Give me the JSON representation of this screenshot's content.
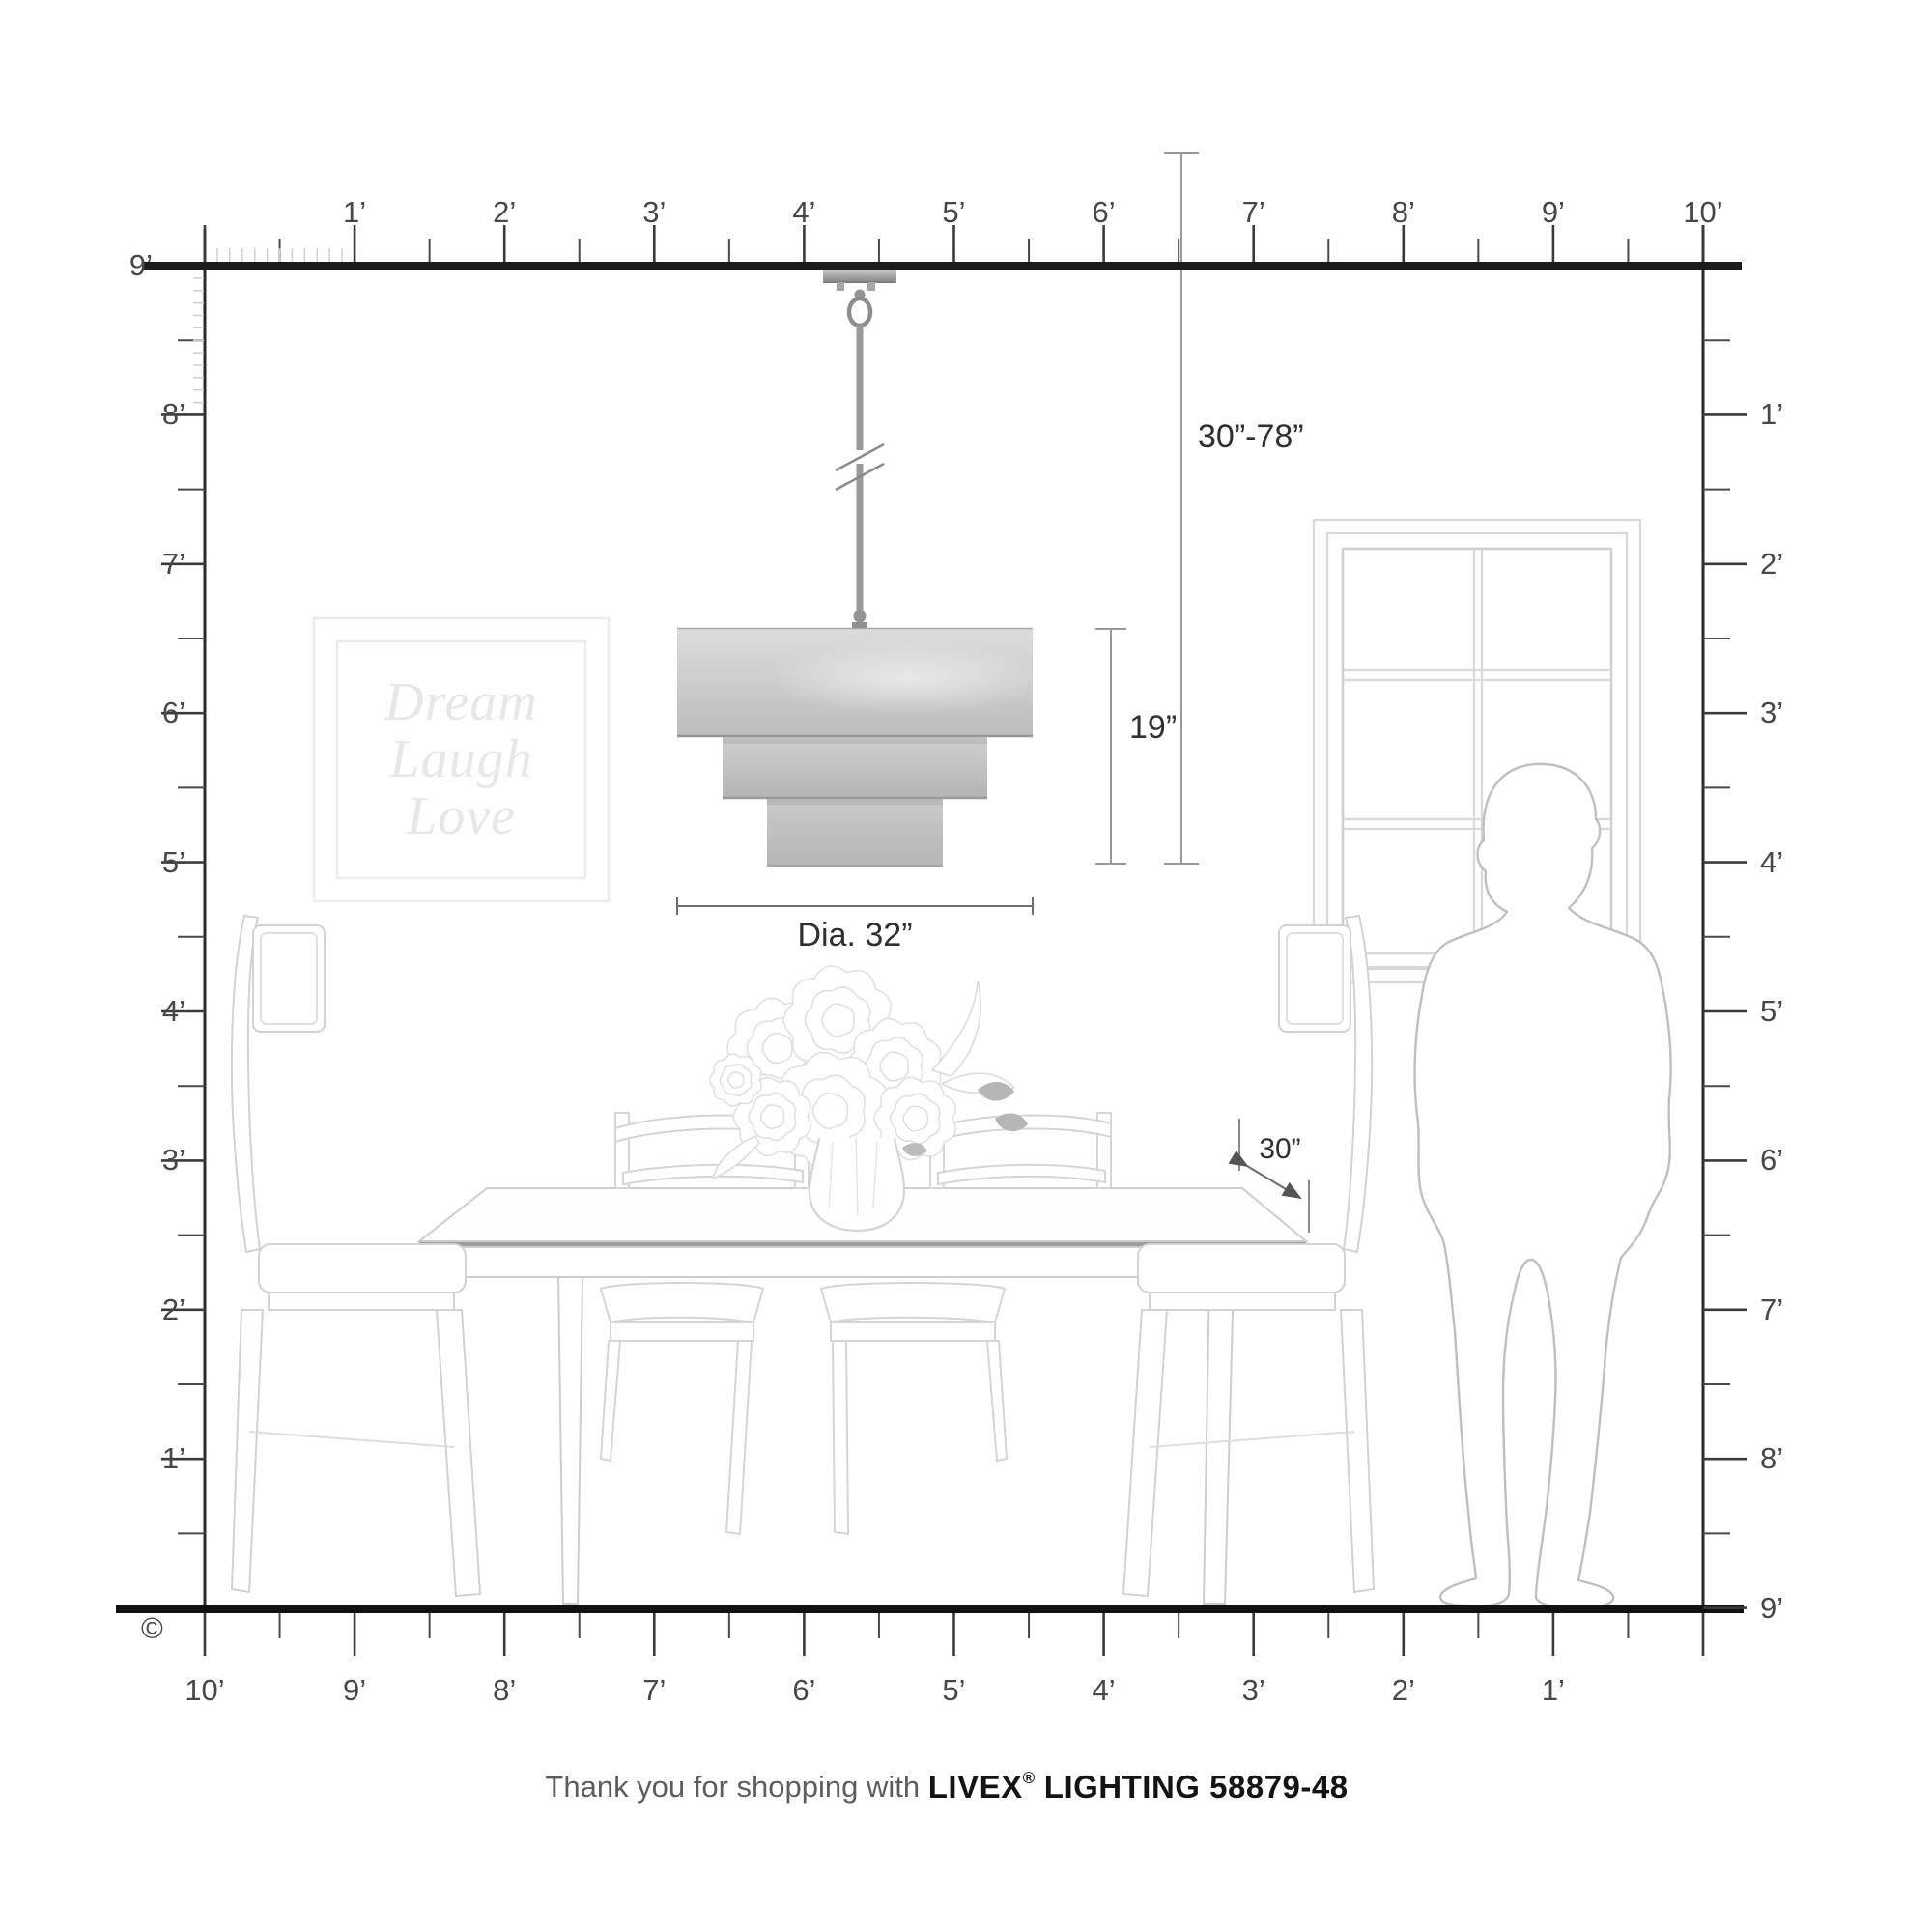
{
  "diagram": {
    "type": "product-scale-diagram",
    "room": {
      "width_feet": 10,
      "height_feet": 9
    }
  },
  "rulers": {
    "top": {
      "labels": [
        "1’",
        "2’",
        "3’",
        "4’",
        "5’",
        "6’",
        "7’",
        "8’",
        "9’",
        "10’"
      ]
    },
    "left": {
      "labels": [
        "9’",
        "8’",
        "7’",
        "6’",
        "5’",
        "4’",
        "3’",
        "2’",
        "1’"
      ]
    },
    "right": {
      "labels": [
        "1’",
        "2’",
        "3’",
        "4’",
        "5’",
        "6’",
        "7’",
        "8’",
        "9’"
      ]
    },
    "bottom": {
      "labels": [
        "10’",
        "9’",
        "8’",
        "7’",
        "6’",
        "5’",
        "4’",
        "3’",
        "2’",
        "1’"
      ]
    }
  },
  "dimensions": {
    "hang_height": "30”-78”",
    "fixture_height": "19”",
    "diameter": "Dia. 32”",
    "table_clearance": "30”"
  },
  "wall_art": {
    "line1": "Dream",
    "line2": "Laugh",
    "line3": "Love"
  },
  "footer": {
    "prefix": "Thank you for shopping with ",
    "brand": "LIVEX",
    "registered": "®",
    "suffix": " LIGHTING 58879-48"
  },
  "copyright": "©",
  "colors": {
    "ruler_bar": "#1c1c1c",
    "tick": "#3a3a3a",
    "minor_tick": "#4a4a4a",
    "inch_tick": "#cfcfcf",
    "label_text": "#474747",
    "dimension_line": "#999999",
    "dimension_text": "#2f2f2f",
    "line_art": "#d6d6d6",
    "person_outline": "#bfbfbf",
    "art_text": "#e7e7e7",
    "shade_light": "#dadada",
    "shade_dark": "#b9b9b9",
    "metal": "#8f8f8f"
  }
}
